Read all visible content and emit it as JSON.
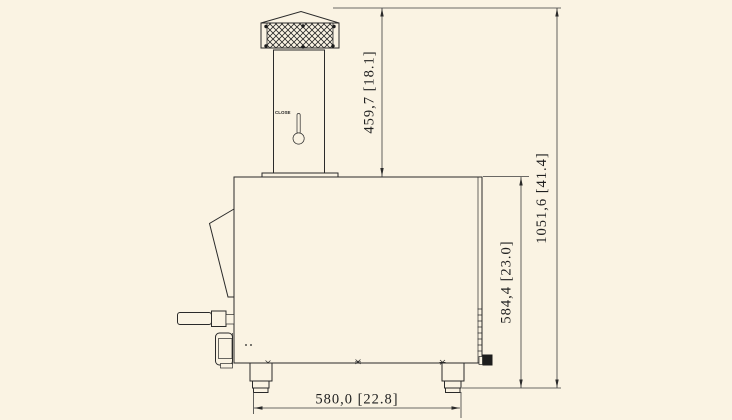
{
  "page": {
    "background_color": "#faf3e3",
    "line_color": "#2a2a2a"
  },
  "drawing": {
    "type": "technical-side-elevation",
    "subject": "machine with chimney stack, sampler handle and feet",
    "dimensions": {
      "chimney_height": "459,7 [18.1]",
      "overall_height": "1051,6 [41.4]",
      "body_height": "584,4 [23.0]",
      "base_width": "580,0 [22.8]"
    },
    "labels": {
      "damper": "CLOSE"
    }
  }
}
